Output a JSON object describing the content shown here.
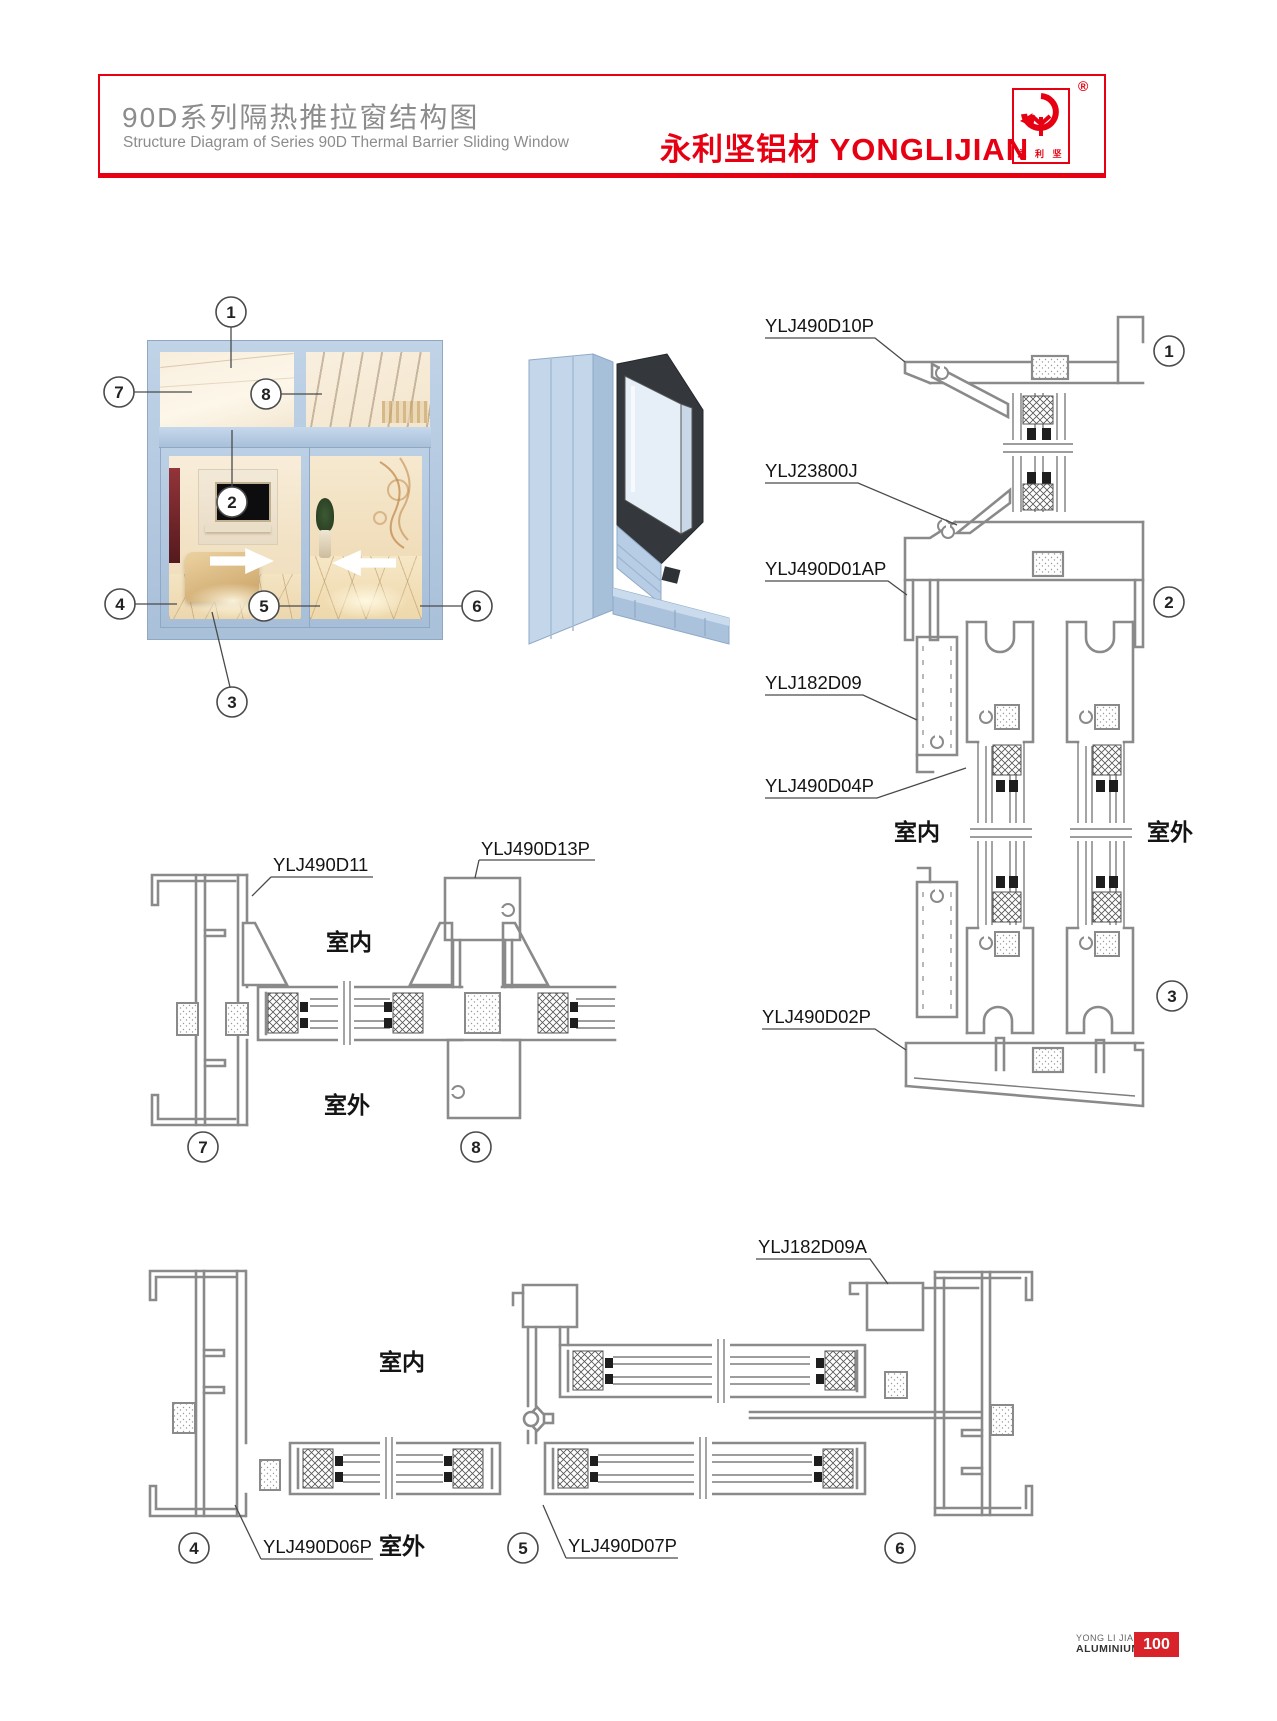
{
  "header": {
    "title_cn": "90D系列隔热推拉窗结构图",
    "title_en": "Structure Diagram of Series 90D Thermal Barrier Sliding Window",
    "brand": "永利坚铝材 YONGLIJIAN",
    "registered": "®",
    "logo_text": "永 利 坚"
  },
  "photo": {
    "callouts": [
      "1",
      "2",
      "3",
      "4",
      "5",
      "6",
      "7",
      "8"
    ]
  },
  "vsec": {
    "labels": [
      "YLJ490D10P",
      "YLJ23800J",
      "YLJ490D01AP",
      "YLJ182D09",
      "YLJ490D04P",
      "YLJ490D02P"
    ],
    "indoor": "室内",
    "outdoor": "室外",
    "callouts": [
      "1",
      "2",
      "3"
    ]
  },
  "ptop": {
    "labels": [
      "YLJ490D11",
      "YLJ490D13P"
    ],
    "indoor": "室内",
    "outdoor": "室外",
    "callouts": [
      "7",
      "8"
    ]
  },
  "pbot": {
    "labels": [
      "YLJ182D09A",
      "YLJ490D06P",
      "YLJ490D07P"
    ],
    "indoor": "室内",
    "outdoor": "室外",
    "callouts": [
      "4",
      "5",
      "6"
    ]
  },
  "footer": {
    "brand_line1": "YONG LI JIAN",
    "brand_line2": "ALUMINIUM",
    "page": "100"
  },
  "colors": {
    "accent_red": "#e60012",
    "drawing_gray": "#8a8a8a",
    "profile_blue": "#b9cde3"
  }
}
